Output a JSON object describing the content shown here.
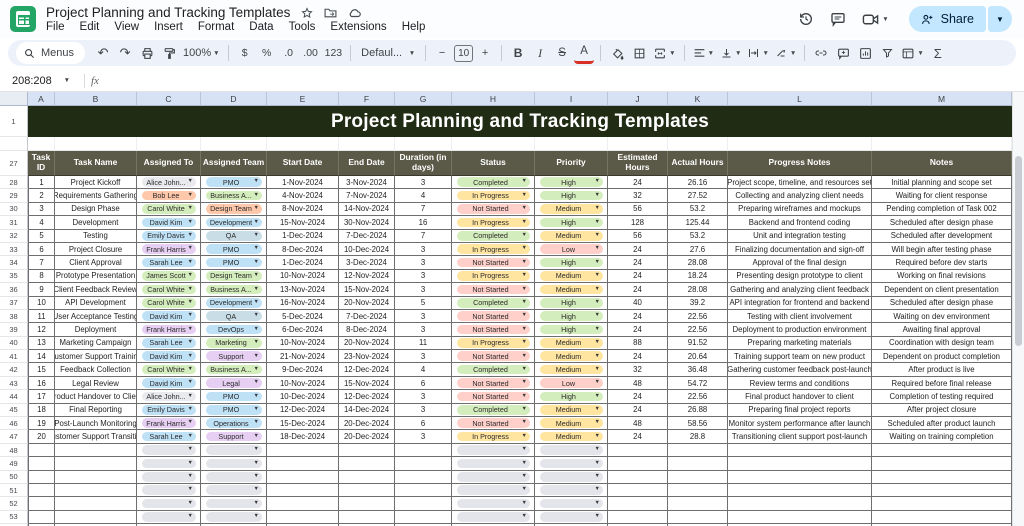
{
  "app": {
    "doc_title": "Project Planning and Tracking Templates",
    "menu_items": [
      "File",
      "Edit",
      "View",
      "Insert",
      "Format",
      "Data",
      "Tools",
      "Extensions",
      "Help"
    ],
    "share_label": "Share"
  },
  "toolbar": {
    "search_label": "Menus",
    "zoom": "100%",
    "currency": "$",
    "percent": "%",
    "dec_decrease": ".0",
    "dec_increase": ".00",
    "fmt_123": "123",
    "font_name": "Defaul...",
    "minus": "−",
    "font_size": "10",
    "plus": "+",
    "bold": "B",
    "italic": "I",
    "strikethrough": "S",
    "text_color": "A",
    "functions": "Σ"
  },
  "formula_bar": {
    "name_box": "208:208",
    "fx_label": "fx"
  },
  "colors": {
    "gray": "#e8eaed",
    "orange": "#ffc8aa",
    "green": "#d4edbc",
    "blue": "#bfe1f6",
    "purple": "#e6cff2",
    "teal": "#c9dde6",
    "yellow": "#ffe5a0",
    "red": "#ffcfc9",
    "empty_chip": "#e3e5ea",
    "banner_bg": "#202c14",
    "header_bg": "#5b5a48",
    "share_bg": "#c2e7ff"
  },
  "layout": {
    "rownum_width": 28,
    "col_widths": [
      27,
      82,
      64,
      66,
      72,
      56,
      57,
      83,
      73,
      60,
      60,
      144,
      140
    ]
  },
  "sheet": {
    "banner": "Project Planning and Tracking Templates",
    "column_letters": [
      "A",
      "B",
      "C",
      "D",
      "E",
      "F",
      "G",
      "H",
      "I",
      "J",
      "K",
      "L",
      "M"
    ],
    "title_row_number": "1",
    "header_row_number": "27",
    "columns": [
      "Task ID",
      "Task Name",
      "Assigned To",
      "Assigned Team",
      "Start Date",
      "End Date",
      "Duration (in days)",
      "Status",
      "Priority",
      "Estimated Hours",
      "Actual Hours",
      "Progress Notes",
      "Notes"
    ],
    "rows": [
      {
        "row_number": "28",
        "task_id": "1",
        "task_name": "Project Kickoff",
        "assigned_to": {
          "label": "Alice John...",
          "color": "gray"
        },
        "team": {
          "label": "PMO",
          "color": "blue"
        },
        "start": "1-Nov-2024",
        "end": "3-Nov-2024",
        "duration": "3",
        "status": {
          "label": "Completed",
          "color": "green"
        },
        "priority": {
          "label": "High",
          "color": "green"
        },
        "estimated": "24",
        "actual": "26.16",
        "progress": "Project scope, timeline, and resources set",
        "notes": "Initial planning and scope set"
      },
      {
        "row_number": "29",
        "task_id": "2",
        "task_name": "Requirements Gathering",
        "assigned_to": {
          "label": "Bob Lee",
          "color": "orange"
        },
        "team": {
          "label": "Business A...",
          "color": "green"
        },
        "start": "4-Nov-2024",
        "end": "7-Nov-2024",
        "duration": "4",
        "status": {
          "label": "In Progress",
          "color": "yellow"
        },
        "priority": {
          "label": "High",
          "color": "green"
        },
        "estimated": "32",
        "actual": "27.52",
        "progress": "Collecting and analyzing client needs",
        "notes": "Waiting for client response"
      },
      {
        "row_number": "30",
        "task_id": "3",
        "task_name": "Design Phase",
        "assigned_to": {
          "label": "Carol White",
          "color": "green"
        },
        "team": {
          "label": "Design Team",
          "color": "orange"
        },
        "start": "8-Nov-2024",
        "end": "14-Nov-2024",
        "duration": "7",
        "status": {
          "label": "Not Started",
          "color": "red"
        },
        "priority": {
          "label": "Medium",
          "color": "yellow"
        },
        "estimated": "56",
        "actual": "53.2",
        "progress": "Preparing wireframes and mockups",
        "notes": "Pending completion of Task 002"
      },
      {
        "row_number": "31",
        "task_id": "4",
        "task_name": "Development",
        "assigned_to": {
          "label": "David Kim",
          "color": "blue"
        },
        "team": {
          "label": "Development",
          "color": "blue"
        },
        "start": "15-Nov-2024",
        "end": "30-Nov-2024",
        "duration": "16",
        "status": {
          "label": "In Progress",
          "color": "yellow"
        },
        "priority": {
          "label": "High",
          "color": "green"
        },
        "estimated": "128",
        "actual": "125.44",
        "progress": "Backend and frontend coding",
        "notes": "Scheduled after design phase"
      },
      {
        "row_number": "32",
        "task_id": "5",
        "task_name": "Testing",
        "assigned_to": {
          "label": "Emily Davis",
          "color": "blue"
        },
        "team": {
          "label": "QA",
          "color": "teal"
        },
        "start": "1-Dec-2024",
        "end": "7-Dec-2024",
        "duration": "7",
        "status": {
          "label": "Completed",
          "color": "green"
        },
        "priority": {
          "label": "Medium",
          "color": "yellow"
        },
        "estimated": "56",
        "actual": "53.2",
        "progress": "Unit and integration testing",
        "notes": "Scheduled after development"
      },
      {
        "row_number": "33",
        "task_id": "6",
        "task_name": "Project Closure",
        "assigned_to": {
          "label": "Frank Harris",
          "color": "purple"
        },
        "team": {
          "label": "PMO",
          "color": "blue"
        },
        "start": "8-Dec-2024",
        "end": "10-Dec-2024",
        "duration": "3",
        "status": {
          "label": "In Progress",
          "color": "yellow"
        },
        "priority": {
          "label": "Low",
          "color": "red"
        },
        "estimated": "24",
        "actual": "27.6",
        "progress": "Finalizing documentation and sign-off",
        "notes": "Will begin after testing phase"
      },
      {
        "row_number": "34",
        "task_id": "7",
        "task_name": "Client Approval",
        "assigned_to": {
          "label": "Sarah Lee",
          "color": "blue"
        },
        "team": {
          "label": "PMO",
          "color": "blue"
        },
        "start": "1-Dec-2024",
        "end": "3-Dec-2024",
        "duration": "3",
        "status": {
          "label": "Not Started",
          "color": "red"
        },
        "priority": {
          "label": "High",
          "color": "green"
        },
        "estimated": "24",
        "actual": "28.08",
        "progress": "Approval of the final design",
        "notes": "Required before dev starts"
      },
      {
        "row_number": "35",
        "task_id": "8",
        "task_name": "Prototype Presentation",
        "assigned_to": {
          "label": "James Scott",
          "color": "green"
        },
        "team": {
          "label": "Design Team",
          "color": "green"
        },
        "start": "10-Nov-2024",
        "end": "12-Nov-2024",
        "duration": "3",
        "status": {
          "label": "In Progress",
          "color": "yellow"
        },
        "priority": {
          "label": "Medium",
          "color": "yellow"
        },
        "estimated": "24",
        "actual": "18.24",
        "progress": "Presenting design prototype to client",
        "notes": "Working on final revisions"
      },
      {
        "row_number": "36",
        "task_id": "9",
        "task_name": "Client Feedback Review",
        "assigned_to": {
          "label": "Carol White",
          "color": "green"
        },
        "team": {
          "label": "Business A...",
          "color": "green"
        },
        "start": "13-Nov-2024",
        "end": "15-Nov-2024",
        "duration": "3",
        "status": {
          "label": "Not Started",
          "color": "red"
        },
        "priority": {
          "label": "Medium",
          "color": "yellow"
        },
        "estimated": "24",
        "actual": "28.08",
        "progress": "Gathering and analyzing client feedback",
        "notes": "Dependent on client presentation"
      },
      {
        "row_number": "37",
        "task_id": "10",
        "task_name": "API Development",
        "assigned_to": {
          "label": "Carol White",
          "color": "green"
        },
        "team": {
          "label": "Development",
          "color": "blue"
        },
        "start": "16-Nov-2024",
        "end": "20-Nov-2024",
        "duration": "5",
        "status": {
          "label": "Completed",
          "color": "green"
        },
        "priority": {
          "label": "High",
          "color": "green"
        },
        "estimated": "40",
        "actual": "39.2",
        "progress": "API integration for frontend and backend",
        "notes": "Scheduled after design phase"
      },
      {
        "row_number": "38",
        "task_id": "11",
        "task_name": "User Acceptance Testing",
        "assigned_to": {
          "label": "David Kim",
          "color": "blue"
        },
        "team": {
          "label": "QA",
          "color": "teal"
        },
        "start": "5-Dec-2024",
        "end": "7-Dec-2024",
        "duration": "3",
        "status": {
          "label": "Not Started",
          "color": "red"
        },
        "priority": {
          "label": "High",
          "color": "green"
        },
        "estimated": "24",
        "actual": "22.56",
        "progress": "Testing with client involvement",
        "notes": "Waiting on dev environment"
      },
      {
        "row_number": "39",
        "task_id": "12",
        "task_name": "Deployment",
        "assigned_to": {
          "label": "Frank Harris",
          "color": "purple"
        },
        "team": {
          "label": "DevOps",
          "color": "blue"
        },
        "start": "6-Dec-2024",
        "end": "8-Dec-2024",
        "duration": "3",
        "status": {
          "label": "Not Started",
          "color": "red"
        },
        "priority": {
          "label": "High",
          "color": "green"
        },
        "estimated": "24",
        "actual": "22.56",
        "progress": "Deployment to production environment",
        "notes": "Awaiting final approval"
      },
      {
        "row_number": "40",
        "task_id": "13",
        "task_name": "Marketing Campaign",
        "assigned_to": {
          "label": "Sarah Lee",
          "color": "blue"
        },
        "team": {
          "label": "Marketing",
          "color": "green"
        },
        "start": "10-Nov-2024",
        "end": "20-Nov-2024",
        "duration": "11",
        "status": {
          "label": "In Progress",
          "color": "yellow"
        },
        "priority": {
          "label": "Medium",
          "color": "yellow"
        },
        "estimated": "88",
        "actual": "91.52",
        "progress": "Preparing marketing materials",
        "notes": "Coordination with design team"
      },
      {
        "row_number": "41",
        "task_id": "14",
        "task_name": "Customer Support Training",
        "assigned_to": {
          "label": "David Kim",
          "color": "blue"
        },
        "team": {
          "label": "Support",
          "color": "purple"
        },
        "start": "21-Nov-2024",
        "end": "23-Nov-2024",
        "duration": "3",
        "status": {
          "label": "Not Started",
          "color": "red"
        },
        "priority": {
          "label": "Medium",
          "color": "yellow"
        },
        "estimated": "24",
        "actual": "20.64",
        "progress": "Training support team on new product",
        "notes": "Dependent on product completion"
      },
      {
        "row_number": "42",
        "task_id": "15",
        "task_name": "Feedback Collection",
        "assigned_to": {
          "label": "Carol White",
          "color": "green"
        },
        "team": {
          "label": "Business A...",
          "color": "green"
        },
        "start": "9-Dec-2024",
        "end": "12-Dec-2024",
        "duration": "4",
        "status": {
          "label": "Completed",
          "color": "green"
        },
        "priority": {
          "label": "Medium",
          "color": "yellow"
        },
        "estimated": "32",
        "actual": "36.48",
        "progress": "Gathering customer feedback post-launch",
        "notes": "After product is live"
      },
      {
        "row_number": "43",
        "task_id": "16",
        "task_name": "Legal Review",
        "assigned_to": {
          "label": "David Kim",
          "color": "blue"
        },
        "team": {
          "label": "Legal",
          "color": "purple"
        },
        "start": "10-Nov-2024",
        "end": "15-Nov-2024",
        "duration": "6",
        "status": {
          "label": "Not Started",
          "color": "red"
        },
        "priority": {
          "label": "Low",
          "color": "red"
        },
        "estimated": "48",
        "actual": "54.72",
        "progress": "Review terms and conditions",
        "notes": "Required before final release"
      },
      {
        "row_number": "44",
        "task_id": "17",
        "task_name": "Product Handover to Client",
        "assigned_to": {
          "label": "Alice John...",
          "color": "gray"
        },
        "team": {
          "label": "PMO",
          "color": "blue"
        },
        "start": "10-Dec-2024",
        "end": "12-Dec-2024",
        "duration": "3",
        "status": {
          "label": "Not Started",
          "color": "red"
        },
        "priority": {
          "label": "High",
          "color": "green"
        },
        "estimated": "24",
        "actual": "22.56",
        "progress": "Final product handover to client",
        "notes": "Completion of testing required"
      },
      {
        "row_number": "45",
        "task_id": "18",
        "task_name": "Final Reporting",
        "assigned_to": {
          "label": "Emily Davis",
          "color": "blue"
        },
        "team": {
          "label": "PMO",
          "color": "blue"
        },
        "start": "12-Dec-2024",
        "end": "14-Dec-2024",
        "duration": "3",
        "status": {
          "label": "Completed",
          "color": "green"
        },
        "priority": {
          "label": "Medium",
          "color": "yellow"
        },
        "estimated": "24",
        "actual": "26.88",
        "progress": "Preparing final project reports",
        "notes": "After project closure"
      },
      {
        "row_number": "46",
        "task_id": "19",
        "task_name": "Post-Launch Monitoring",
        "assigned_to": {
          "label": "Frank Harris",
          "color": "purple"
        },
        "team": {
          "label": "Operations",
          "color": "blue"
        },
        "start": "15-Dec-2024",
        "end": "20-Dec-2024",
        "duration": "6",
        "status": {
          "label": "Not Started",
          "color": "red"
        },
        "priority": {
          "label": "Medium",
          "color": "yellow"
        },
        "estimated": "48",
        "actual": "58.56",
        "progress": "Monitor system performance after launch",
        "notes": "Scheduled after product launch"
      },
      {
        "row_number": "47",
        "task_id": "20",
        "task_name": "Customer Support Transition",
        "assigned_to": {
          "label": "Sarah Lee",
          "color": "blue"
        },
        "team": {
          "label": "Support",
          "color": "purple"
        },
        "start": "18-Dec-2024",
        "end": "20-Dec-2024",
        "duration": "3",
        "status": {
          "label": "In Progress",
          "color": "yellow"
        },
        "priority": {
          "label": "Medium",
          "color": "yellow"
        },
        "estimated": "24",
        "actual": "28.8",
        "progress": "Transitioning client support post-launch",
        "notes": "Waiting on training completion"
      }
    ],
    "empty_row_numbers": [
      "48",
      "49",
      "50",
      "51",
      "52",
      "53",
      "54"
    ]
  }
}
